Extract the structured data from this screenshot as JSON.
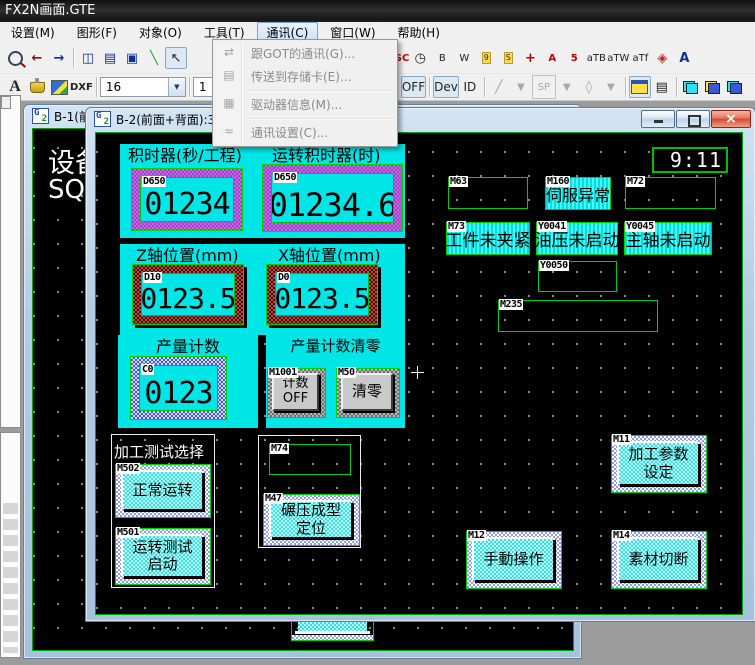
{
  "app": {
    "title": "FX2N画面.GTE"
  },
  "menubar": {
    "items": [
      "设置(M)",
      "图形(F)",
      "对象(O)",
      "工具(T)",
      "通讯(C)",
      "窗口(W)",
      "帮助(H)"
    ]
  },
  "comm_menu": {
    "items": [
      "跟GOT的通讯(G)...",
      "传送到存储卡(E)...",
      "驱动器信息(M)...",
      "通讯设置(C)..."
    ],
    "icons": [
      "⇄",
      "▤",
      "▦",
      "≈"
    ]
  },
  "toolbar": {
    "icons_left": [
      "←",
      "→",
      "◫",
      "▤",
      "▣",
      "╲",
      "↖"
    ],
    "icons_right": [
      "123",
      "ASC",
      "◷",
      "B",
      "W",
      "9",
      "S",
      "+",
      "A",
      "5",
      "aTB",
      "aTW",
      "aTf",
      "◈",
      "A"
    ],
    "a_label": "A",
    "dxf_label": "DXF",
    "font_size": "16",
    "combo2_value": "1",
    "on_label": "ON",
    "off_label": "OFF",
    "dev_label": "Dev",
    "id_label": "ID",
    "sp_label": "SP",
    "drop_glyph": "▼"
  },
  "windows": {
    "b1": {
      "title": "B-1(前",
      "text1": "设备",
      "text2": "SQR"
    },
    "b2": {
      "title": "B-2(前面+背面):3"
    }
  },
  "hmi": {
    "clock": "9:11",
    "timer": {
      "title1": "积时器(秒/工程)",
      "title2": "运转积时器(时)",
      "dev1": "D650",
      "val1": "01234",
      "dev2": "D650",
      "val2": "01234.6"
    },
    "axis": {
      "title1": "Z轴位置(mm)",
      "title2": "X轴位置(mm)",
      "dev1": "D10",
      "val1": "0123.5",
      "dev2": "D0",
      "val2": "0123.5"
    },
    "count": {
      "title": "产量计数",
      "dev": "C0",
      "val": "0123"
    },
    "clear": {
      "title": "产量计数清零",
      "btn1_dev": "M1001",
      "btn1_label": "计数\nOFF",
      "btn2_dev": "M50",
      "btn2_label": "清零"
    },
    "lamps": {
      "m63": {
        "dev": "M63"
      },
      "m160": {
        "dev": "M160",
        "text": "伺服异常"
      },
      "m72": {
        "dev": "M72"
      },
      "m73": {
        "dev": "M73",
        "text": "工件未夹紧"
      },
      "y0041": {
        "dev": "Y0041",
        "text": "油压未启动"
      },
      "y0045": {
        "dev": "Y0045",
        "text": "主轴未启动"
      },
      "y0050": {
        "dev": "Y0050"
      },
      "m235": {
        "dev": "M235"
      },
      "m74": {
        "dev": "M74"
      }
    },
    "test": {
      "title": "加工测试选择",
      "btn1_dev": "M502",
      "btn1_label": "正常运转",
      "btn2_dev": "M501",
      "btn2_label": "运转测试\n启动"
    },
    "m47": {
      "dev": "M47",
      "label": "碾压成型\n定位"
    },
    "m11": {
      "dev": "M11",
      "label": "加工参数\n设定"
    },
    "m12": {
      "dev": "M12",
      "label": "手動操作"
    },
    "m14": {
      "dev": "M14",
      "label": "素材切断"
    }
  }
}
